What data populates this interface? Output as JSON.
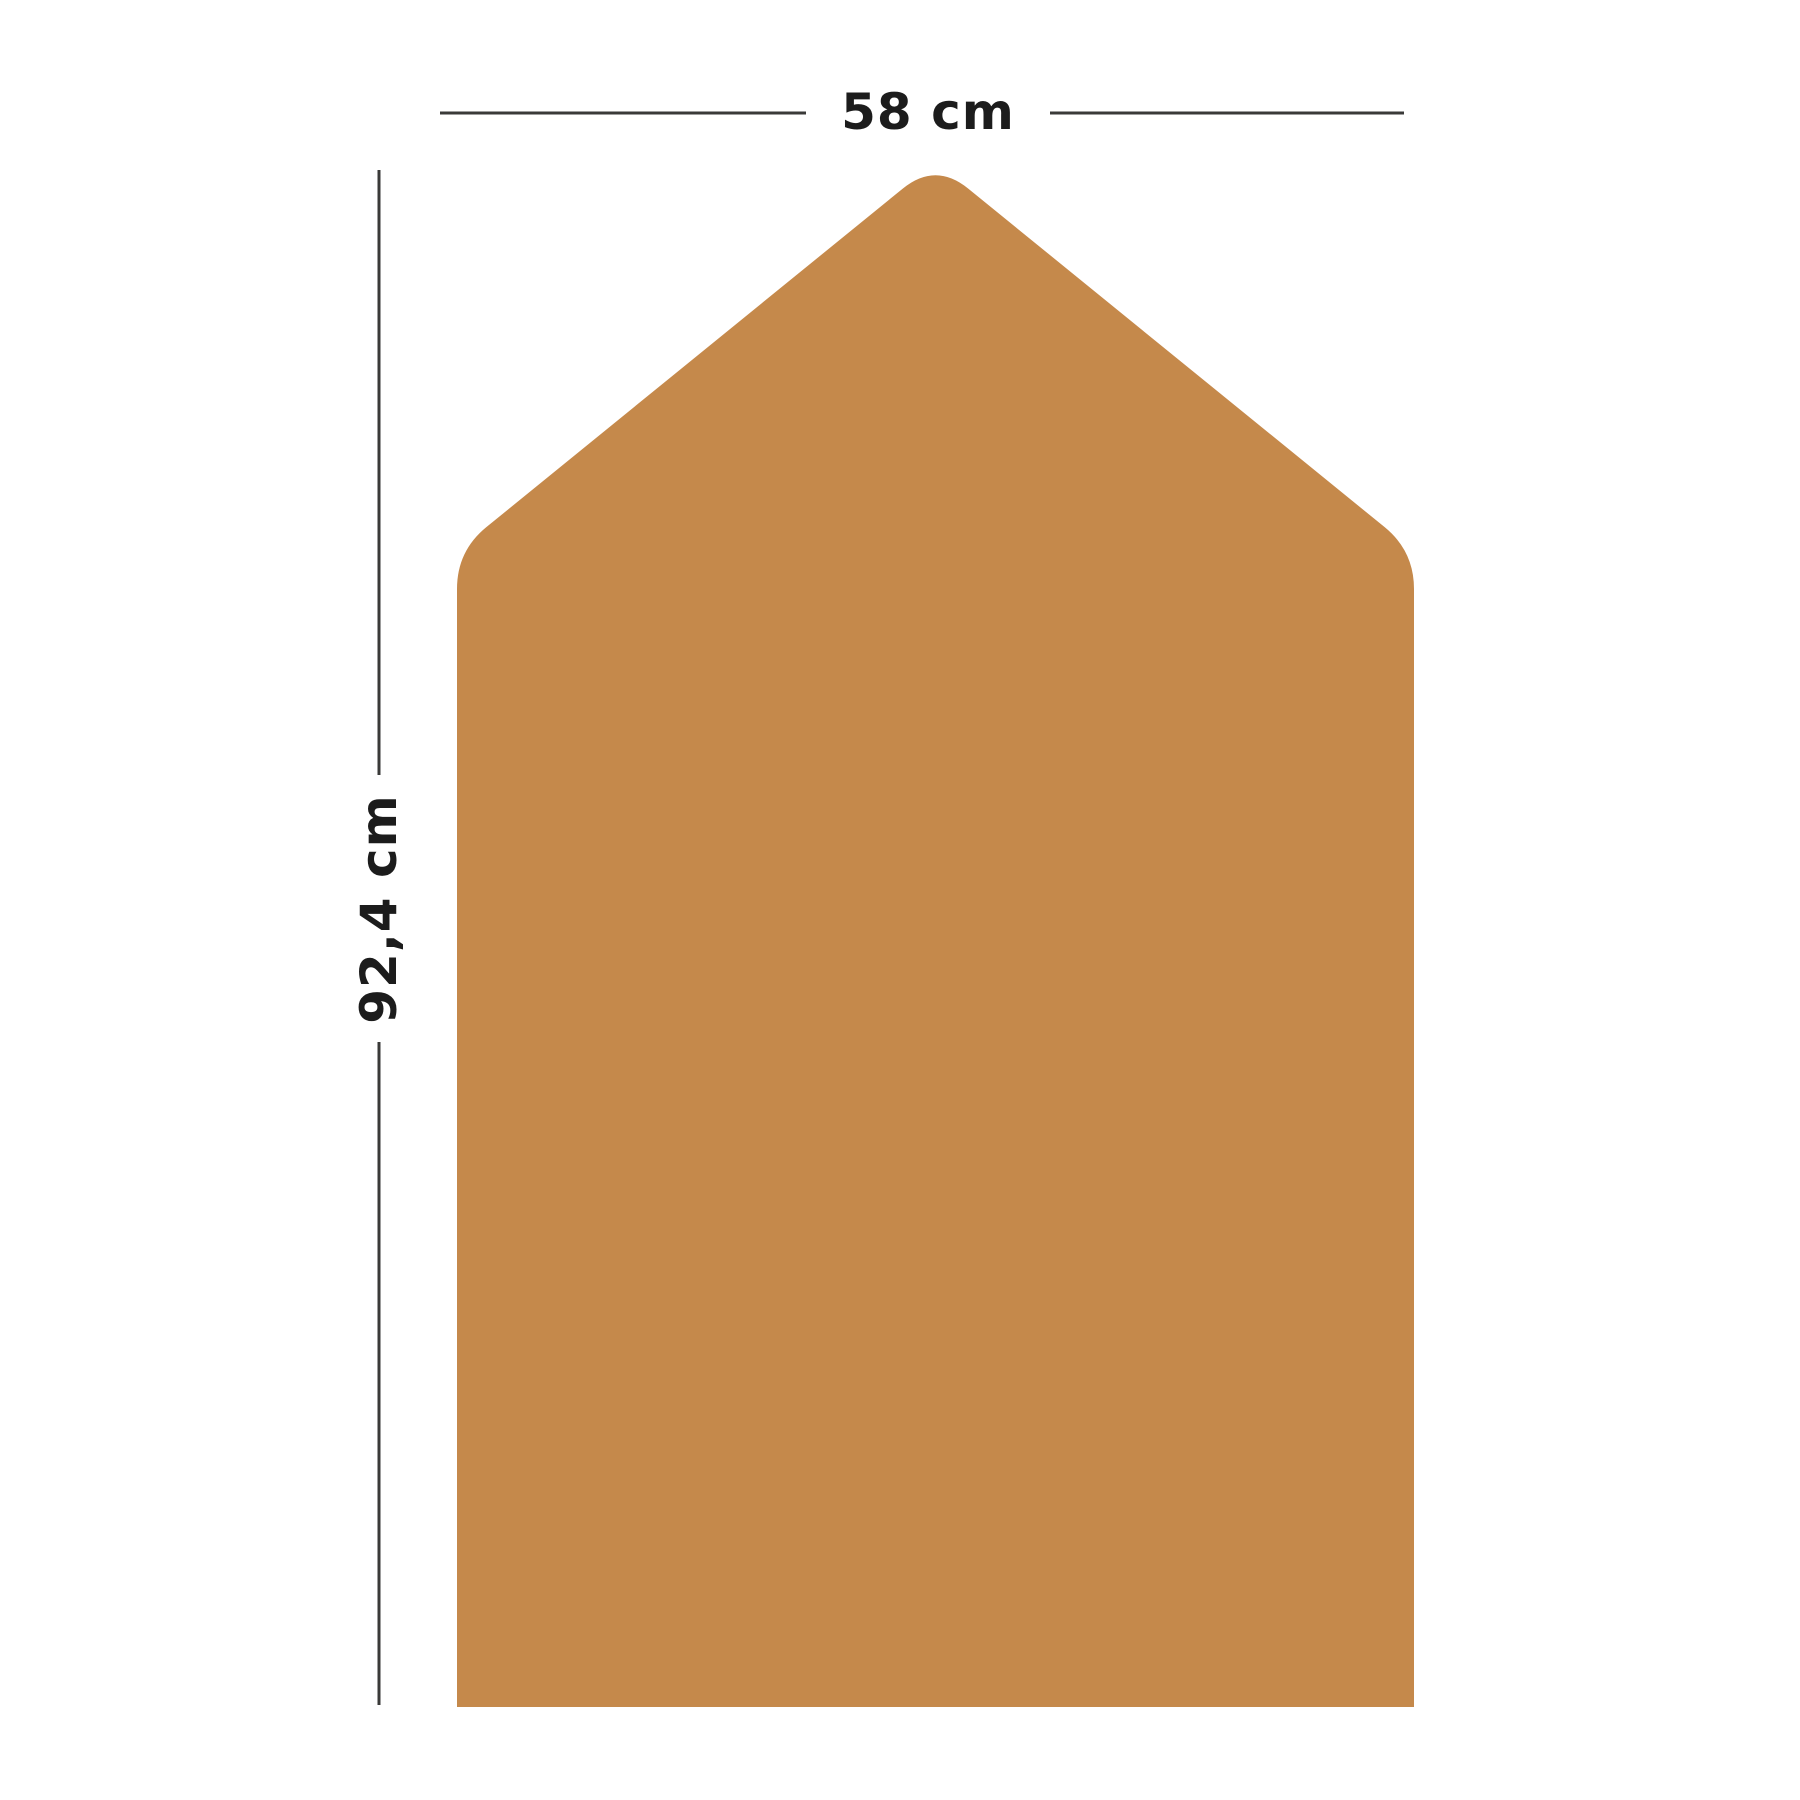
{
  "figure": {
    "title": "panel-dimension-diagram",
    "background_color": "#ffffff",
    "text_color": "#1c1c1c",
    "line_color": "#3a3a38",
    "line_width": 3,
    "shape": {
      "description": "house-shaped panel with rounded apex and eave corners, square bottom corners",
      "fill_color": "#c5894b",
      "points": [
        [
          457,
          1707
        ],
        [
          457,
          551
        ],
        [
          935.5,
          162
        ],
        [
          1414,
          551
        ],
        [
          1414,
          1707
        ]
      ],
      "corner_offsets": [
        0,
        38,
        42,
        38,
        0
      ]
    },
    "dimensions": {
      "width": {
        "label": "58 cm",
        "label_x": 928,
        "label_y": 112,
        "rotation": 0,
        "segments": [
          [
            440,
            113,
            806,
            113
          ],
          [
            1050,
            113,
            1404,
            113
          ]
        ]
      },
      "height": {
        "label": "92,4 cm",
        "label_x": 379,
        "label_y": 909,
        "rotation": -90,
        "segments": [
          [
            379,
            170,
            379,
            775
          ],
          [
            379,
            1042,
            379,
            1705
          ]
        ]
      }
    }
  }
}
